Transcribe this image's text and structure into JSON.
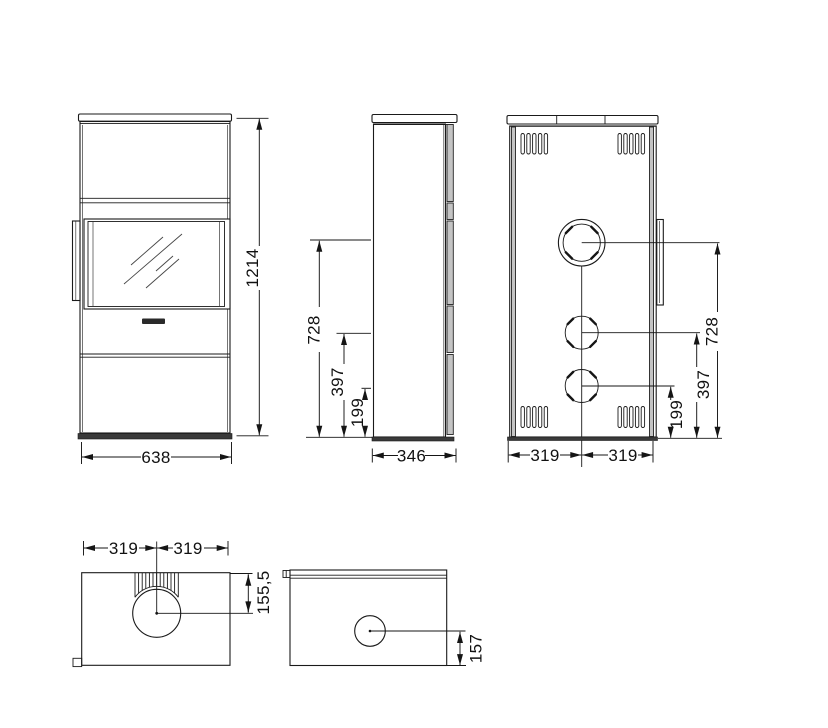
{
  "front_view": {
    "height": "1214",
    "width": "638"
  },
  "side_view": {
    "depth": "346",
    "flue_center_height": "728",
    "outlet_mid_height": "397",
    "outlet_low_height": "199"
  },
  "back_view": {
    "flue_center_height": "728",
    "outlet_mid_height": "397",
    "outlet_low_height": "199",
    "width_left_half": "319",
    "width_right_half": "319"
  },
  "top_view": {
    "width_left_half": "319",
    "width_right_half": "319",
    "flue_center_offset": "155,5"
  },
  "bottom_view": {
    "outlet_center_offset": "157"
  }
}
